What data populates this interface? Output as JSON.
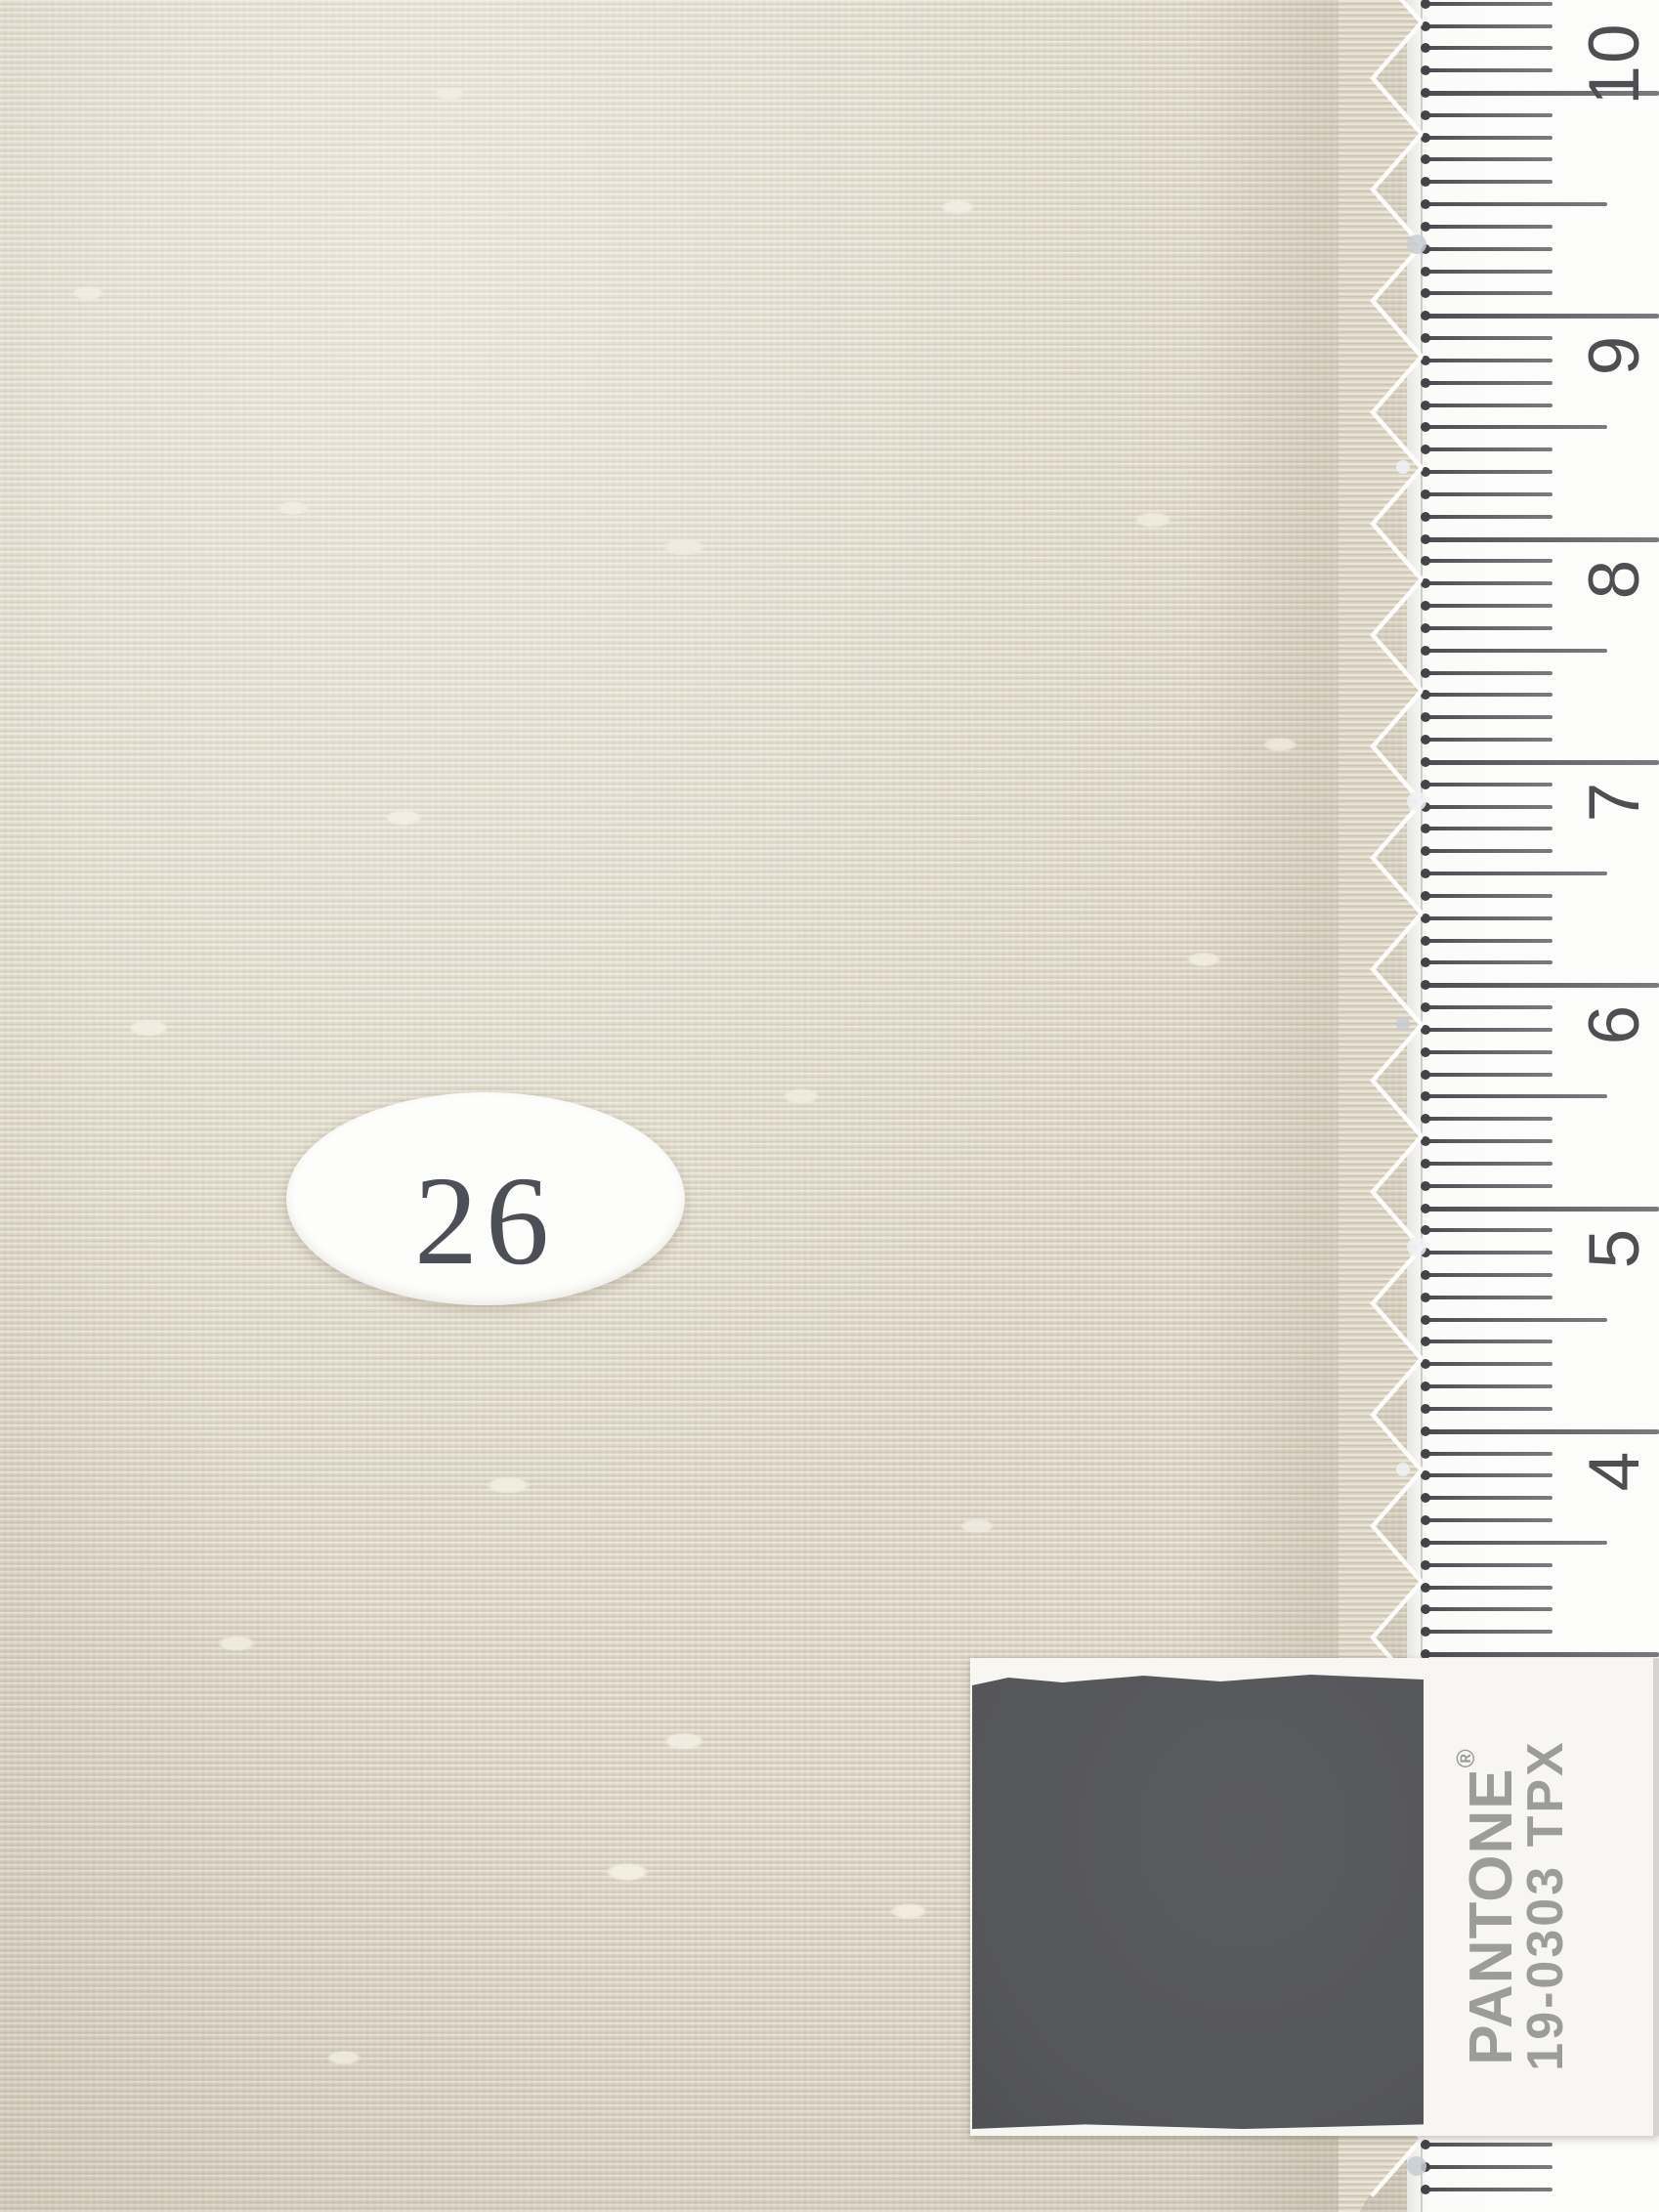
{
  "swatch_label": {
    "number": "26"
  },
  "ruler": {
    "cm_labels": [
      "10",
      "9",
      "8",
      "7",
      "6",
      "5",
      "4"
    ]
  },
  "pantone_card": {
    "brand": "PANTONE",
    "registered_mark": "®",
    "code": "19-0303 TPX"
  },
  "colors": {
    "fabric_base": "#dcd5c5",
    "ruler_background": "#fbfbf9",
    "tick": "#54565a",
    "ruler_digit": "#4d4f52",
    "pantone_swatch": "#56575a",
    "pantone_label_background": "#f7f6f3",
    "pantone_text": "#9c9c9a",
    "sticker_background": "#fdfdfb",
    "sticker_text": "#4c5056"
  }
}
